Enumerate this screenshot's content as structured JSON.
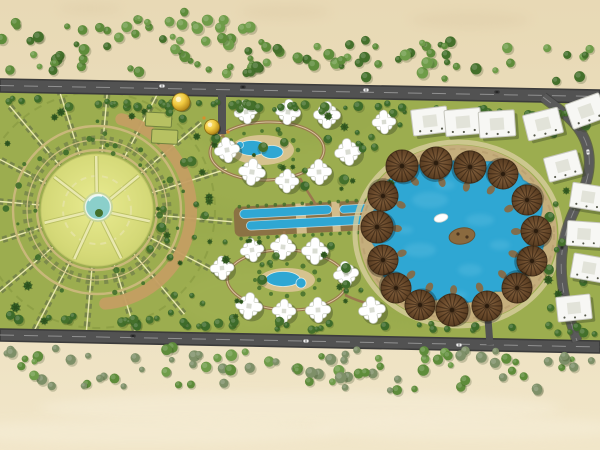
{
  "scene": {
    "width": 600,
    "height": 450
  },
  "palette": {
    "sandTop": "#e8d9b5",
    "sandMid": "#ecdfbe",
    "sandBottom": "#f1e6c9",
    "beachWash": "#f6eed8",
    "sandShade": "#dcc9a4",
    "siteGreen": "#9cad4f",
    "siteGreenDark": "#85973f",
    "siteGreenLight": "#b7c162",
    "roadFill": "#525252",
    "roadEdge": "#3b3b3b",
    "roadLine": "#a0a0a0",
    "gardenLawn": "#d5d978",
    "gardenPath": "#e9e8ae",
    "ringOlive": "#77854a",
    "ringTan": "#c9b87a",
    "crescentTan": "#c49e62",
    "pond": "#8bcfca",
    "water": "#2fa7d3",
    "waterLight": "#55bade",
    "waterDeep": "#1f86b2",
    "deck": "#d9c492",
    "prom": "#c7ae7e",
    "promLight": "#d8cd9e",
    "canalBase": "#8a6b44",
    "umbrellaRim": "#46311b",
    "villaShadow": "rgba(55,65,35,0.38)",
    "tree1": "#5e8c3a",
    "tree2": "#44702b",
    "tree3": "#6f9c49",
    "treeGray": "#7e9068",
    "palm": "#3d6b2a",
    "carLight": "#efefef",
    "carDark": "#343434",
    "gold": "#f0c93f",
    "island": "#8a6a3f",
    "boat": "#ffffff"
  },
  "sand": {
    "beachBlobs": [
      [
        300,
        408,
        260,
        16
      ],
      [
        140,
        432,
        200,
        12
      ],
      [
        470,
        428,
        160,
        12
      ]
    ],
    "topBlobs": [
      [
        285,
        12,
        45,
        8
      ],
      [
        90,
        9,
        32,
        6
      ],
      [
        470,
        20,
        60,
        9
      ]
    ]
  },
  "treeBands": [
    {
      "name": "top-corner-trees",
      "x0": 0,
      "x1": 255,
      "y0": 12,
      "y1": 38,
      "slope": 0,
      "count": 26,
      "seed": 3,
      "colors": [
        "tree1",
        "tree3"
      ]
    },
    {
      "name": "top-tree-band",
      "x0": 0,
      "x1": 600,
      "y0": 34,
      "y1": 72,
      "slope": 10,
      "count": 92,
      "seed": 11,
      "colors": [
        "tree1",
        "tree2",
        "tree3"
      ]
    },
    {
      "name": "bottom-tree-band",
      "x0": 0,
      "x1": 600,
      "y0": 345,
      "y1": 386,
      "slope": 7,
      "count": 95,
      "seed": 23,
      "colors": [
        "tree1",
        "tree3",
        "treeGray",
        "treeGray"
      ]
    },
    {
      "name": "hedge-row-top",
      "x0": 4,
      "x1": 600,
      "y0": 98,
      "y1": 106,
      "slope": 11,
      "count": 54,
      "seed": 31,
      "colors": [
        "tree2",
        "palm"
      ]
    },
    {
      "name": "hedge-row-bottom",
      "x0": 4,
      "x1": 600,
      "y0": 314,
      "y1": 324,
      "slope": 11,
      "count": 48,
      "seed": 37,
      "colors": [
        "tree2",
        "palm"
      ]
    }
  ],
  "scatterRegions": [
    {
      "x0": 148,
      "x1": 215,
      "y0": 105,
      "y1": 322,
      "count": 26,
      "seed": 41
    },
    {
      "x0": 205,
      "x1": 400,
      "y0": 98,
      "y1": 195,
      "count": 20,
      "seed": 43
    },
    {
      "x0": 205,
      "x1": 405,
      "y0": 238,
      "y1": 320,
      "count": 20,
      "seed": 47
    },
    {
      "x0": 545,
      "x1": 597,
      "y0": 105,
      "y1": 318,
      "count": 14,
      "seed": 53
    },
    {
      "x0": 348,
      "x1": 382,
      "y0": 118,
      "y1": 162,
      "count": 6,
      "seed": 59
    }
  ],
  "siteTexture": [
    [
      150,
      160,
      60,
      30,
      "siteGreenLight",
      0.14
    ],
    [
      300,
      120,
      80,
      25,
      "siteGreenDark",
      0.12
    ],
    [
      250,
      300,
      70,
      30,
      "siteGreenLight",
      0.12
    ],
    [
      420,
      300,
      60,
      25,
      "siteGreenDark",
      0.1
    ],
    [
      200,
      220,
      50,
      20,
      "siteGreenDark",
      0.08
    ]
  ],
  "roads": {
    "top": {
      "poly": "0,79 600,90 600,103 0,92",
      "line": [
        0,
        85.5,
        600,
        96.5
      ]
    },
    "bottom": {
      "poly": "0,329 600,341 600,353 0,341",
      "line": [
        0,
        335,
        600,
        347
      ]
    },
    "right": {
      "d": "M543,97 C562,112 586,126 589,156 C592,186 573,204 565,236 C557,268 562,296 577,341",
      "w": 9
    },
    "entries": [
      {
        "d": "M222,92 L222,134",
        "w": 8
      },
      {
        "d": "M487,306 L490,345",
        "w": 7
      }
    ]
  },
  "cars": [
    [
      162,
      86,
      1,
      "carLight"
    ],
    [
      243,
      87,
      1,
      "carDark"
    ],
    [
      366,
      90,
      1,
      "carLight"
    ],
    [
      497,
      92,
      1,
      "carDark"
    ],
    [
      133,
      336,
      1,
      "carDark"
    ],
    [
      306,
      341,
      1,
      "carLight"
    ],
    [
      459,
      345,
      1,
      "carLight"
    ],
    [
      588,
      152,
      85,
      "carLight"
    ],
    [
      562,
      247,
      95,
      "carDark"
    ]
  ],
  "garden": {
    "cx": 97,
    "cy": 210,
    "lawnR": 56,
    "pond": {
      "cx": 98,
      "cy": 207,
      "r": 12.5
    },
    "spokes": {
      "count": 16,
      "angle0": 5,
      "r0": 58,
      "r1": 136
    },
    "rings": [
      {
        "r": 60,
        "type": "tan"
      },
      {
        "r": 70,
        "type": "teeth"
      },
      {
        "r": 84,
        "type": "tan"
      },
      {
        "r": 118,
        "type": "faint"
      }
    ],
    "crescent": {
      "r": 94,
      "a0": -75,
      "a1": 85,
      "w": 12
    },
    "innerPaths": {
      "count": 7,
      "angle0": 12
    },
    "innerRingR": 34,
    "shrubs": {
      "count": 30,
      "seed": 61,
      "r0": 58,
      "r1": 92
    },
    "outerPalms": {
      "count": 10,
      "seed": 67,
      "r0": 100,
      "r1": 130
    }
  },
  "plots": [
    [
      146,
      112,
      26,
      14,
      3
    ],
    [
      152,
      129,
      26,
      14,
      3
    ]
  ],
  "domes": [
    [
      181,
      102,
      9
    ],
    [
      212,
      127,
      7.5
    ]
  ],
  "accents": [
    [
      228,
      132
    ],
    [
      204,
      118
    ]
  ],
  "canal": {
    "rotate": -3,
    "cx": 330,
    "cy": 216,
    "base": [
      234,
      202,
      192,
      30
    ],
    "strips": [
      [
        240,
        205,
        92,
        9
      ],
      [
        246,
        217,
        150,
        9
      ],
      [
        340,
        206,
        78,
        8
      ],
      [
        402,
        216,
        22,
        9
      ]
    ],
    "crossings": [
      [
        296,
        202,
        10,
        30
      ],
      [
        332,
        202,
        8,
        30
      ]
    ],
    "fringeY": [
      202,
      234
    ],
    "fringeX0": 238,
    "fringeX1": 422
  },
  "clusters": [
    {
      "name": "villa-cluster-a",
      "loop": [
        267,
        151,
        57,
        29,
        -2
      ],
      "deck": [
        262,
        150,
        32,
        15
      ],
      "pools": [
        [
          252,
          148,
          15,
          7.5
        ],
        [
          272,
          152,
          11,
          6.5
        ],
        [
          240,
          145,
          3.5,
          3.5
        ]
      ],
      "villas": [
        [
          246,
          112
        ],
        [
          288,
          112
        ],
        [
          327,
          115
        ],
        [
          384,
          122
        ],
        [
          227,
          150
        ],
        [
          252,
          172
        ],
        [
          287,
          181
        ],
        [
          319,
          172
        ],
        [
          348,
          152
        ]
      ],
      "links": [
        "M300,178 C306,190 312,198 316,205",
        "M222,134 C228,146 240,152 252,156"
      ]
    },
    {
      "name": "villa-cluster-b",
      "loop": [
        287,
        280,
        60,
        30,
        2
      ],
      "deck": [
        287,
        280,
        28,
        12
      ],
      "pools": [
        [
          283,
          279,
          17,
          7.5
        ],
        [
          301,
          283,
          5,
          5
        ]
      ],
      "villas": [
        [
          252,
          250
        ],
        [
          283,
          247
        ],
        [
          315,
          251
        ],
        [
          222,
          268
        ],
        [
          346,
          274
        ],
        [
          249,
          306
        ],
        [
          284,
          311
        ],
        [
          318,
          310
        ],
        [
          372,
          310
        ]
      ],
      "links": [
        "M287,250 C286,243 285,237 284,231",
        "M345,295 C355,300 365,303 374,305"
      ]
    }
  ],
  "lagoon": {
    "cx": 458,
    "cy": 233,
    "blob": "M400,175 C420,160 450,157 470,165 C490,157 516,164 523,180 C541,190 546,205 539,220 C549,235 544,256 531,266 C526,283 508,293 495,291 C480,303 459,306 445,298 C425,304 404,296 397,284 C381,279 371,262 376,248 C365,235 367,214 380,204 C377,189 388,177 400,175 Z",
    "promenade": {
      "rx": 88,
      "ry": 78,
      "w": 22
    },
    "outerPath": {
      "rx": 103,
      "ry": 92,
      "w": 5
    },
    "walkway": {
      "rx": 96,
      "ry": 85,
      "w": 2
    },
    "umbrellas": [
      [
        402,
        166,
        16
      ],
      [
        436,
        163,
        16
      ],
      [
        470,
        167,
        16
      ],
      [
        503,
        174,
        15
      ],
      [
        383,
        196,
        15
      ],
      [
        527,
        200,
        15
      ],
      [
        377,
        227,
        16
      ],
      [
        536,
        231,
        15
      ],
      [
        383,
        260,
        15
      ],
      [
        532,
        261,
        15
      ],
      [
        396,
        288,
        15
      ],
      [
        517,
        288,
        15
      ],
      [
        420,
        305,
        15
      ],
      [
        452,
        310,
        16
      ],
      [
        487,
        306,
        15
      ]
    ],
    "boat": [
      441,
      218
    ],
    "island": [
      462,
      236
    ],
    "texture": [
      [
        430,
        200,
        18,
        8
      ],
      [
        480,
        220,
        14,
        6
      ],
      [
        420,
        250,
        16,
        7
      ],
      [
        470,
        270,
        12,
        6
      ],
      [
        500,
        245,
        10,
        5
      ],
      [
        445,
        185,
        10,
        5
      ],
      [
        405,
        230,
        8,
        4
      ],
      [
        458,
        295,
        9,
        4
      ]
    ]
  },
  "buildings": {
    "topRow": [
      [
        430,
        121,
        -7
      ],
      [
        463,
        122,
        -5
      ],
      [
        497,
        124,
        -4
      ],
      [
        543,
        124,
        -14
      ],
      [
        586,
        111,
        -20
      ]
    ],
    "rightCol": [
      [
        563,
        166,
        -15
      ],
      [
        588,
        197,
        9
      ],
      [
        584,
        234,
        4
      ],
      [
        589,
        268,
        10
      ],
      [
        574,
        308,
        -6
      ]
    ]
  }
}
